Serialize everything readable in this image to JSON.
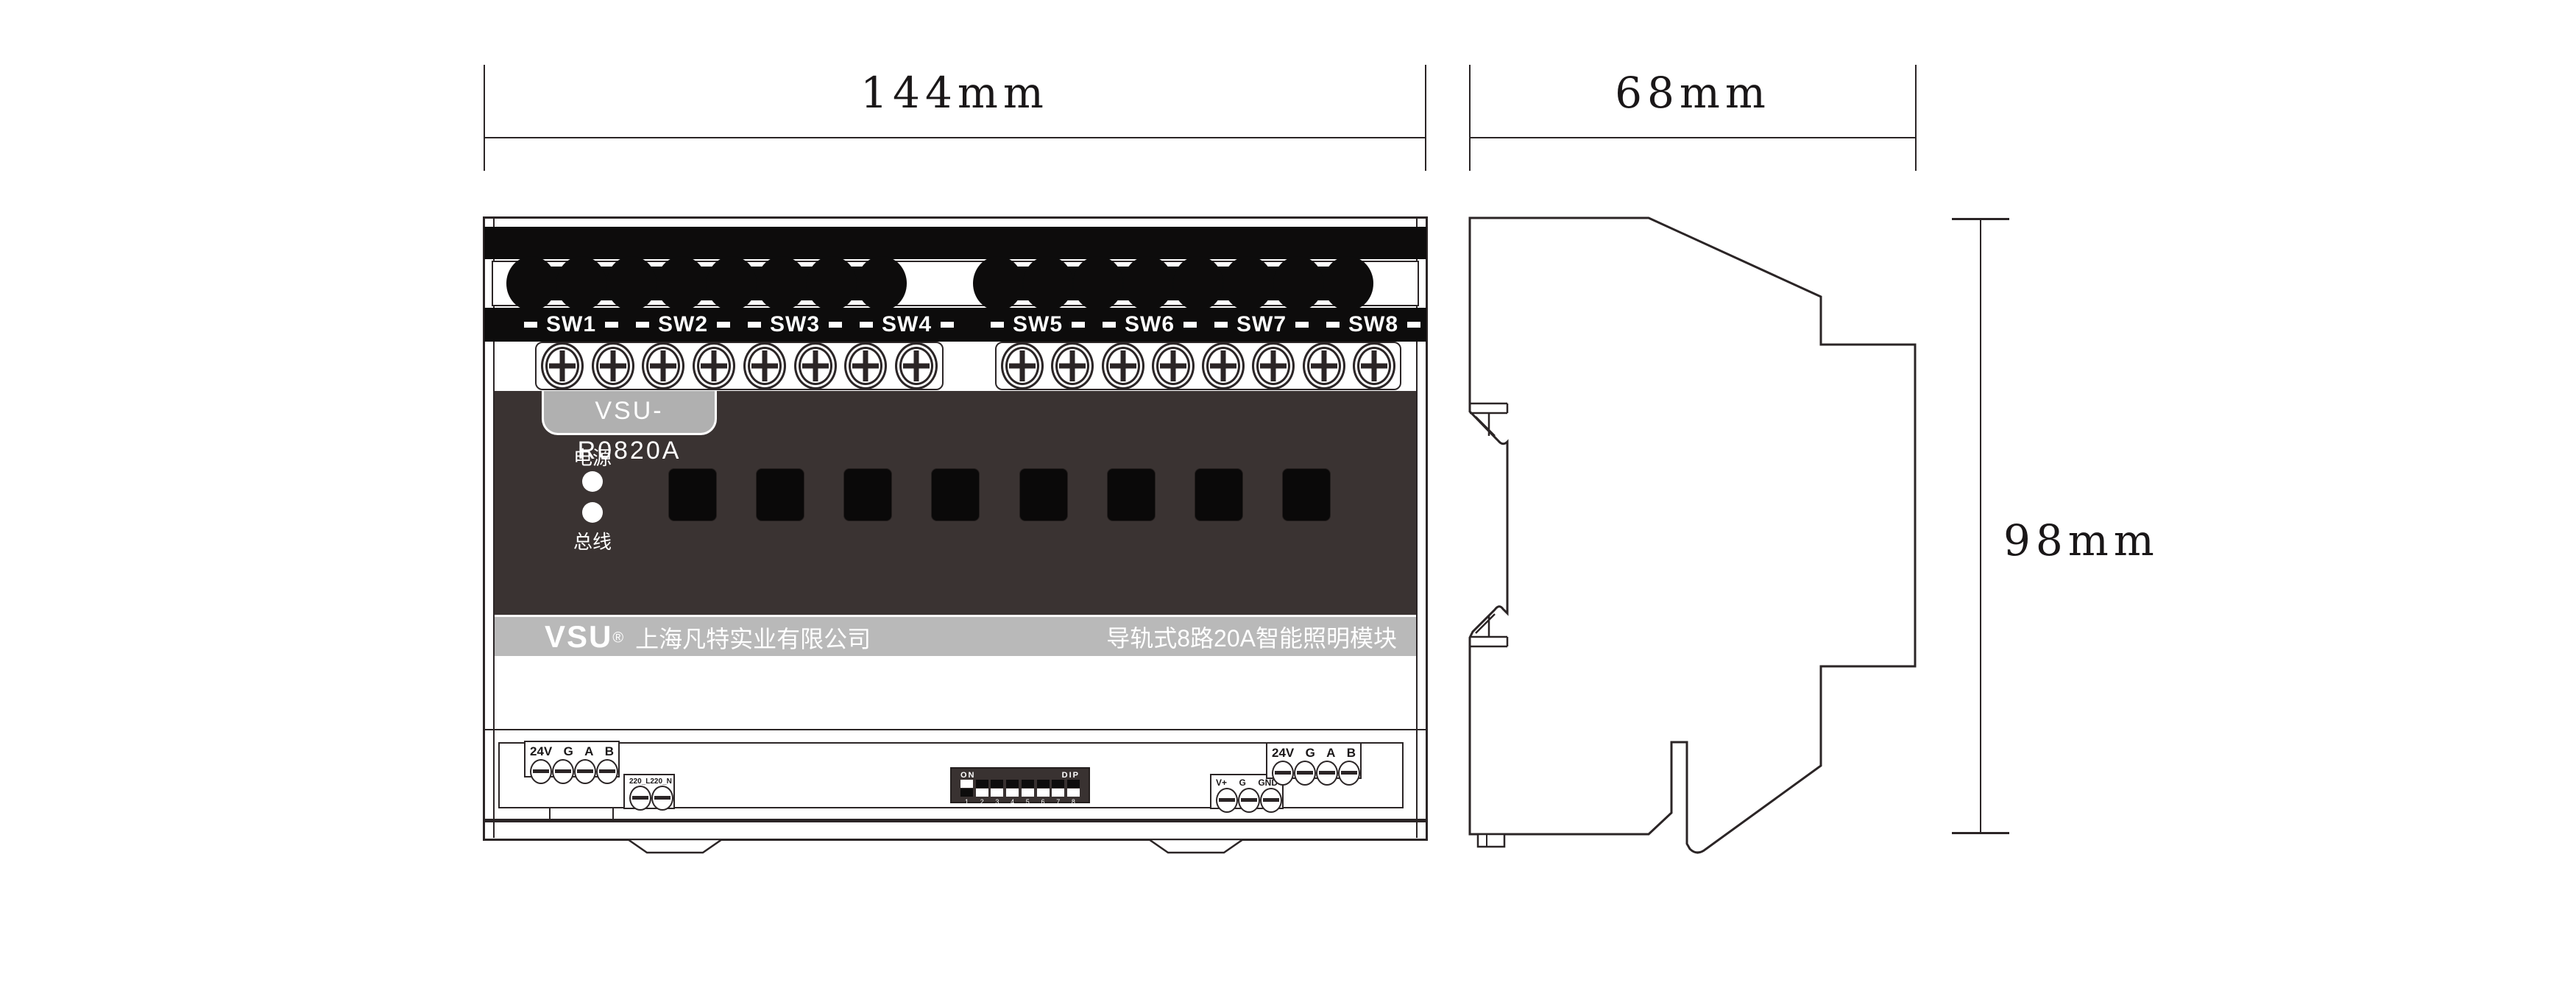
{
  "dims": {
    "front_width": "144mm",
    "side_width": "68mm",
    "height": "98mm"
  },
  "front": {
    "model": "VSU-R0820A",
    "led_top_label": "电源",
    "led_bottom_label": "总线",
    "sw_groups": [
      [
        "SW1",
        "SW2",
        "SW3",
        "SW4"
      ],
      [
        "SW5",
        "SW6",
        "SW7",
        "SW8"
      ]
    ],
    "brand": {
      "logo": "VSU",
      "reg": "®",
      "company": "上海凡特实业有限公司",
      "product": "导轨式8路20A智能照明模块"
    },
    "terminals": {
      "left_bus": {
        "labels": [
          "24V",
          "G",
          "A",
          "B"
        ]
      },
      "mains": {
        "labels": [
          "220_L",
          "220_N"
        ]
      },
      "aux": {
        "labels": [
          "V+",
          "G",
          "GND"
        ]
      },
      "right_bus": {
        "labels": [
          "24V",
          "G",
          "A",
          "B"
        ]
      },
      "dip": {
        "on": "ON",
        "name": "DIP",
        "numbers": [
          "1",
          "2",
          "3",
          "4",
          "5",
          "6",
          "7",
          "8"
        ],
        "up_states": [
          true,
          false,
          false,
          false,
          false,
          false,
          false,
          false
        ]
      }
    }
  },
  "colors": {
    "panel_dark": "#3a3332",
    "label_band": "#b9b9b9",
    "model_tab": "#b0b0b0",
    "outline": "#2b2526",
    "black_fill": "#0d0c0c"
  }
}
